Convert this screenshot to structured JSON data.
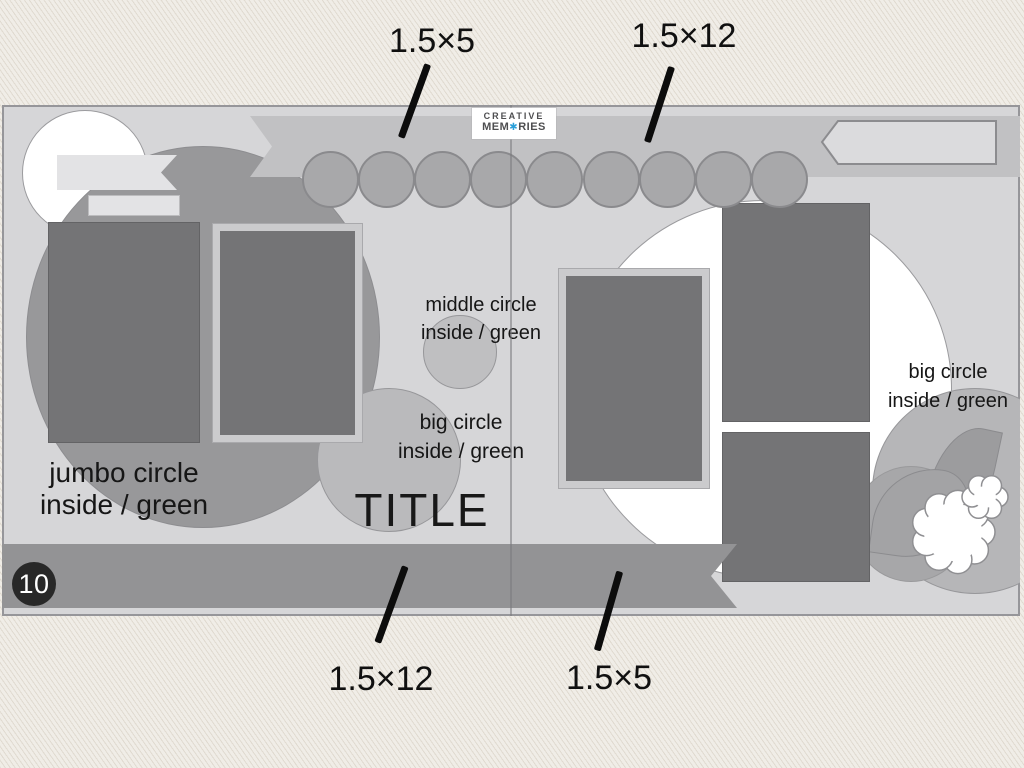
{
  "brand": {
    "line1": "creative",
    "line2_pre": "mem",
    "o_glyph": "✱",
    "line2_post": "ries",
    "full_name": "creative memories"
  },
  "sketch": {
    "number": "10",
    "title_placeholder": "TITLE",
    "labels": {
      "jumbo_circle": {
        "line1": "jumbo circle",
        "line2": "inside / green"
      },
      "middle_circle": {
        "line1": "middle circle",
        "line2": "inside / green"
      },
      "big_circle_left": {
        "line1": "big circle",
        "line2": "inside / green"
      },
      "big_circle_right": {
        "line1": "big circle",
        "line2": "inside / green"
      }
    },
    "dimensions": {
      "top_left": "1.5×5",
      "top_right": "1.5×12",
      "bottom_left": "1.5×12",
      "bottom_right": "1.5×5"
    }
  },
  "colors": {
    "accent_blue": "#2b9fd9",
    "page_gray": "#d6d6d8",
    "banner_gray": "#c1c1c3",
    "bottom_bar_gray": "#939395",
    "photo_gray": "#747476",
    "badge_black": "#282828"
  }
}
